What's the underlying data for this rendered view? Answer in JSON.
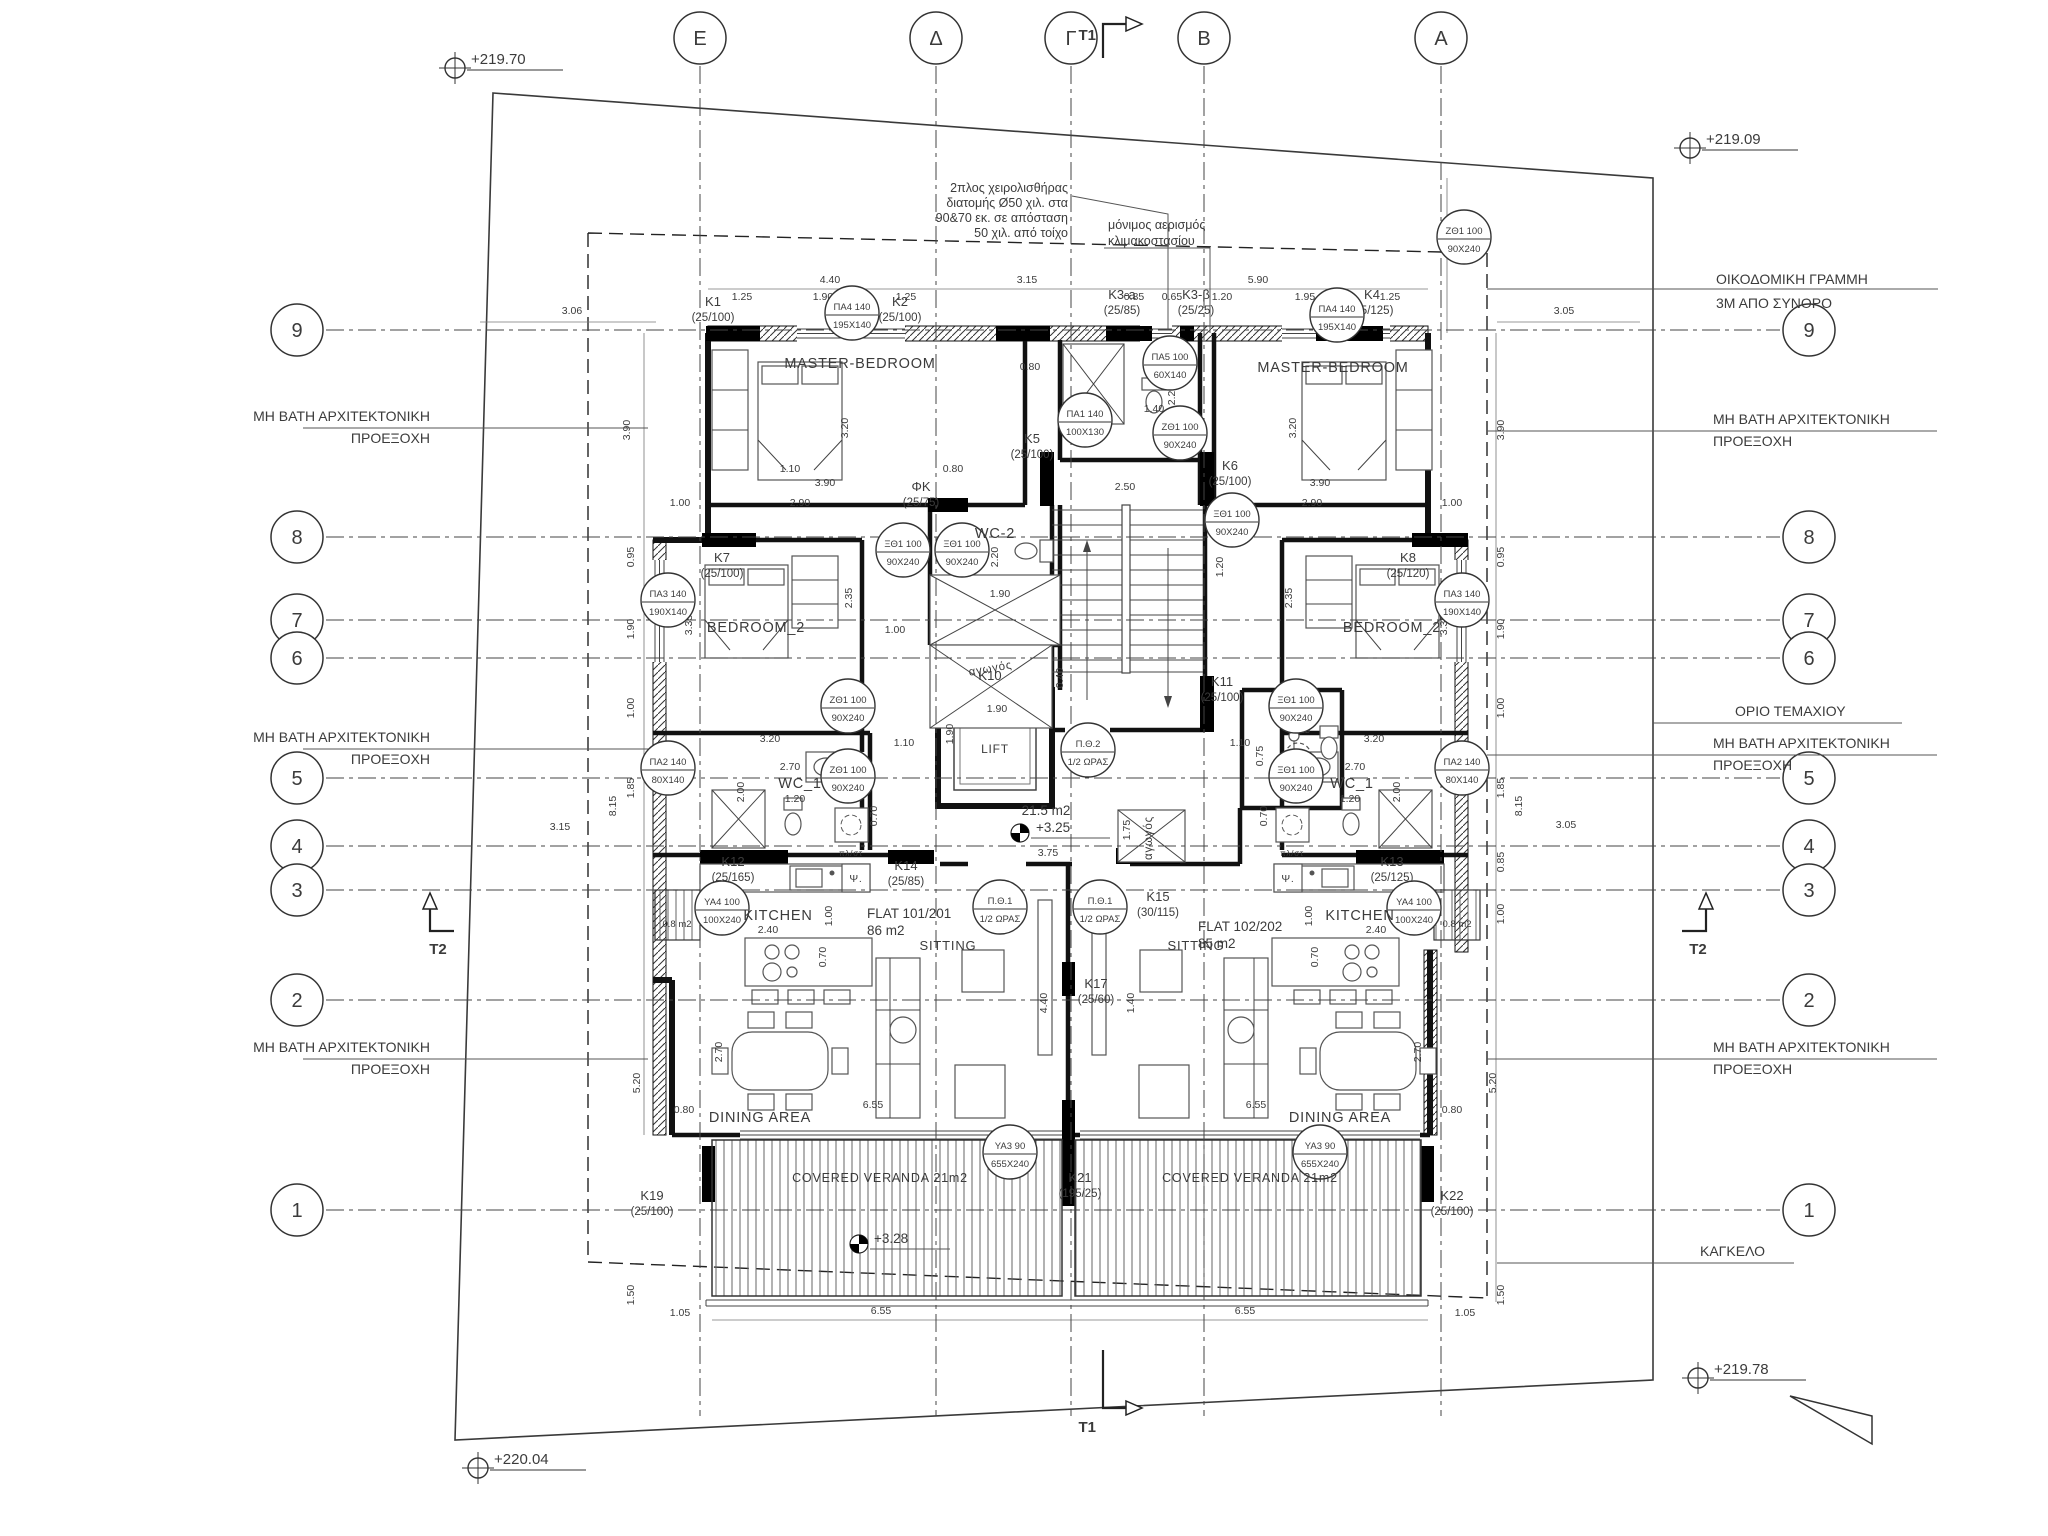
{
  "title": "Typical floor plan",
  "grid": {
    "columns": [
      {
        "l": "E",
        "x": 700
      },
      {
        "l": "Δ",
        "x": 936
      },
      {
        "l": "Γ",
        "x": 1071
      },
      {
        "l": "B",
        "x": 1204
      },
      {
        "l": "A",
        "x": 1441
      }
    ],
    "rows": [
      {
        "l": "9",
        "y": 330
      },
      {
        "l": "8",
        "y": 537
      },
      {
        "l": "7",
        "y": 620
      },
      {
        "l": "6",
        "y": 658
      },
      {
        "l": "5",
        "y": 778
      },
      {
        "l": "4",
        "y": 846
      },
      {
        "l": "3",
        "y": 890
      },
      {
        "l": "2",
        "y": 1000
      },
      {
        "l": "1",
        "y": 1210
      }
    ]
  },
  "markers": {
    "t1": "T1",
    "t2": "T2"
  },
  "levels": [
    {
      "t": "+219.70",
      "x": 455,
      "y": 68
    },
    {
      "t": "+219.09",
      "x": 1690,
      "y": 148
    },
    {
      "t": "+220.04",
      "x": 478,
      "y": 1468
    },
    {
      "t": "+219.78",
      "x": 1698,
      "y": 1378
    }
  ],
  "levels_rel": {
    "hall": "+3.25",
    "veranda": "+3.28"
  },
  "rooms": {
    "master": "MASTER-BEDROOM",
    "bedroom2": "BEDROOM_2",
    "wc1": "WC_1",
    "wc2": "WC-2",
    "kitchen": "KITCHEN",
    "sitting": "SITTING",
    "dining": "DINING AREA",
    "veranda": "COVERED VERANDA 21m2",
    "lift": "LIFT",
    "duct": "αγωγός",
    "fridge": "Ψ.",
    "wash": "πλ/στ"
  },
  "flats": {
    "f1_name": "FLAT 101/201",
    "f1_area": "86 m2",
    "f2_name": "FLAT 102/202",
    "f2_area": "85 m2",
    "hall_area": "21.5 m2",
    "shaft": "0.8 m2"
  },
  "notes": {
    "handrail": [
      "2πλος χειρολισθήρας",
      "διατομής Ø50 χιλ. στα",
      "90&70 εκ. σε απόσταση",
      "50 χιλ. από τοίχο"
    ],
    "vent": [
      "μόνιμος αερισμός",
      "κλιμακοστασίου"
    ],
    "building_line": [
      "ΟΙΚΟΔΟΜΙΚΗ ΓΡΑΜΜΗ",
      "3Μ ΑΠΟ ΣΥΝΟΡΟ"
    ],
    "plot_boundary": "ΟΡΙΟ ΤΕΜΑΧΙΟΥ",
    "railing": "ΚΑΓΚΕΛΟ",
    "projection": [
      "ΜΗ ΒΑΤΗ ΑΡΧΙΤΕΚΤΟΝΙΚΗ",
      "ΠΡΟΕΞΟΧΗ"
    ]
  },
  "projections": [
    {
      "x": 430,
      "y": 421,
      "side": "l"
    },
    {
      "x": 430,
      "y": 742,
      "side": "l"
    },
    {
      "x": 430,
      "y": 1052,
      "side": "l"
    },
    {
      "x": 1713,
      "y": 424,
      "side": "r"
    },
    {
      "x": 1713,
      "y": 748,
      "side": "r"
    },
    {
      "x": 1713,
      "y": 1052,
      "side": "r"
    }
  ],
  "columns": [
    {
      "id": "K1",
      "s": "(25/100)",
      "x": 713,
      "y": 306
    },
    {
      "id": "K2",
      "s": "(25/100)",
      "x": 900,
      "y": 306
    },
    {
      "id": "K3-a",
      "s": "(25/85)",
      "x": 1122,
      "y": 299
    },
    {
      "id": "K3-β",
      "s": "(25/25)",
      "x": 1196,
      "y": 299
    },
    {
      "id": "K4",
      "s": "(25/125)",
      "x": 1372,
      "y": 299
    },
    {
      "id": "K5",
      "s": "(25/100)",
      "x": 1032,
      "y": 443
    },
    {
      "id": "K6",
      "s": "(25/100)",
      "x": 1230,
      "y": 470
    },
    {
      "id": "K7",
      "s": "(25/100)",
      "x": 722,
      "y": 562
    },
    {
      "id": "K8",
      "s": "(25/120)",
      "x": 1408,
      "y": 562
    },
    {
      "id": "ΦΚ",
      "s": "(25/75)",
      "x": 921,
      "y": 491
    },
    {
      "id": "K10",
      "s": "",
      "x": 990,
      "y": 680
    },
    {
      "id": "K11",
      "s": "(25/100)",
      "x": 1222,
      "y": 686
    },
    {
      "id": "K12",
      "s": "(25/165)",
      "x": 733,
      "y": 866
    },
    {
      "id": "K13",
      "s": "(25/125)",
      "x": 1392,
      "y": 866
    },
    {
      "id": "K14",
      "s": "(25/85)",
      "x": 906,
      "y": 870
    },
    {
      "id": "K15",
      "s": "(30/115)",
      "x": 1158,
      "y": 901
    },
    {
      "id": "K17",
      "s": "(25/60)",
      "x": 1096,
      "y": 988
    },
    {
      "id": "K19",
      "s": "(25/100)",
      "x": 652,
      "y": 1200
    },
    {
      "id": "K21",
      "s": "(195/25)",
      "x": 1080,
      "y": 1182
    },
    {
      "id": "K22",
      "s": "(25/100)",
      "x": 1452,
      "y": 1200
    }
  ],
  "tags": [
    {
      "c": "ΠΑ4 140",
      "s": "195X140",
      "x": 852,
      "y": 313
    },
    {
      "c": "ΠΑ4 140",
      "s": "195X140",
      "x": 1337,
      "y": 315
    },
    {
      "c": "ΠΑ5 100",
      "s": "60X140",
      "x": 1170,
      "y": 363
    },
    {
      "c": "ΠΑ1 140",
      "s": "100X130",
      "x": 1085,
      "y": 420
    },
    {
      "c": "ΞΘ1 100",
      "s": "90X240",
      "x": 903,
      "y": 550
    },
    {
      "c": "ΞΘ1 100",
      "s": "90X240",
      "x": 962,
      "y": 550
    },
    {
      "c": "ΞΘ1 100",
      "s": "90X240",
      "x": 1232,
      "y": 520
    },
    {
      "c": "ΖΘ1 100",
      "s": "90X240",
      "x": 1464,
      "y": 237
    },
    {
      "c": "ΖΘ1 100",
      "s": "90X240",
      "x": 1180,
      "y": 433
    },
    {
      "c": "ΠΑ3 140",
      "s": "190X140",
      "x": 668,
      "y": 600
    },
    {
      "c": "ΠΑ3 140",
      "s": "190X140",
      "x": 1462,
      "y": 600
    },
    {
      "c": "ΖΘ1 100",
      "s": "90X240",
      "x": 848,
      "y": 706
    },
    {
      "c": "ΞΘ1 100",
      "s": "90X240",
      "x": 1296,
      "y": 706
    },
    {
      "c": "ΖΘ1 100",
      "s": "90X240",
      "x": 848,
      "y": 776
    },
    {
      "c": "ΞΘ1 100",
      "s": "90X240",
      "x": 1296,
      "y": 776
    },
    {
      "c": "ΠΑ2 140",
      "s": "80X140",
      "x": 668,
      "y": 768
    },
    {
      "c": "ΠΑ2 140",
      "s": "80X140",
      "x": 1462,
      "y": 768
    },
    {
      "c": "ΥΑ4 100",
      "s": "100X240",
      "x": 722,
      "y": 908
    },
    {
      "c": "ΥΑ4 100",
      "s": "100X240",
      "x": 1414,
      "y": 908
    },
    {
      "c": "Π.Θ.1",
      "s": "1/2 ΩΡΑΣ",
      "x": 1000,
      "y": 907
    },
    {
      "c": "Π.Θ.1",
      "s": "1/2 ΩΡΑΣ",
      "x": 1100,
      "y": 907
    },
    {
      "c": "Π.Θ.2",
      "s": "1/2 ΩΡΑΣ",
      "x": 1088,
      "y": 750
    },
    {
      "c": "ΥΑ3 90",
      "s": "655X240",
      "x": 1010,
      "y": 1152
    },
    {
      "c": "ΥΑ3 90",
      "s": "655X240",
      "x": 1320,
      "y": 1152
    }
  ],
  "dims": [
    {
      "t": "4.40",
      "x": 830,
      "y": 283
    },
    {
      "t": "3.15",
      "x": 1027,
      "y": 283
    },
    {
      "t": "5.90",
      "x": 1258,
      "y": 283
    },
    {
      "t": "1.25",
      "x": 742,
      "y": 300
    },
    {
      "t": "1.90",
      "x": 823,
      "y": 300
    },
    {
      "t": "1.25",
      "x": 906,
      "y": 300
    },
    {
      "t": "0.85",
      "x": 1134,
      "y": 300
    },
    {
      "t": "0.65",
      "x": 1172,
      "y": 300
    },
    {
      "t": "1.20",
      "x": 1222,
      "y": 300
    },
    {
      "t": "1.95",
      "x": 1305,
      "y": 300
    },
    {
      "t": "1.25",
      "x": 1390,
      "y": 300
    },
    {
      "t": "3.06",
      "x": 572,
      "y": 314
    },
    {
      "t": "3.05",
      "x": 1564,
      "y": 314
    },
    {
      "t": "4.28",
      "x": 1452,
      "y": 230,
      "r": 1
    },
    {
      "t": "3.90",
      "x": 630,
      "y": 430,
      "r": 1
    },
    {
      "t": "0.95",
      "x": 634,
      "y": 557,
      "r": 1
    },
    {
      "t": "1.90",
      "x": 634,
      "y": 629,
      "r": 1
    },
    {
      "t": "1.00",
      "x": 634,
      "y": 708,
      "r": 1
    },
    {
      "t": "1.85",
      "x": 634,
      "y": 788,
      "r": 1
    },
    {
      "t": "8.15",
      "x": 616,
      "y": 806,
      "r": 1
    },
    {
      "t": "3.15",
      "x": 560,
      "y": 830
    },
    {
      "t": "5.20",
      "x": 640,
      "y": 1083,
      "r": 1
    },
    {
      "t": "0.80",
      "x": 684,
      "y": 1113
    },
    {
      "t": "1.50",
      "x": 634,
      "y": 1295,
      "r": 1
    },
    {
      "t": "1.05",
      "x": 680,
      "y": 1316
    },
    {
      "t": "3.90",
      "x": 1504,
      "y": 430,
      "r": 1
    },
    {
      "t": "0.95",
      "x": 1504,
      "y": 557,
      "r": 1
    },
    {
      "t": "1.90",
      "x": 1504,
      "y": 629,
      "r": 1
    },
    {
      "t": "1.00",
      "x": 1504,
      "y": 708,
      "r": 1
    },
    {
      "t": "1.85",
      "x": 1504,
      "y": 788,
      "r": 1
    },
    {
      "t": "8.15",
      "x": 1522,
      "y": 806,
      "r": 1
    },
    {
      "t": "0.85",
      "x": 1504,
      "y": 862,
      "r": 1
    },
    {
      "t": "1.00",
      "x": 1504,
      "y": 914,
      "r": 1
    },
    {
      "t": "3.05",
      "x": 1566,
      "y": 828
    },
    {
      "t": "5.20",
      "x": 1496,
      "y": 1083,
      "r": 1
    },
    {
      "t": "0.80",
      "x": 1452,
      "y": 1113
    },
    {
      "t": "1.50",
      "x": 1504,
      "y": 1295,
      "r": 1
    },
    {
      "t": "1.05",
      "x": 1465,
      "y": 1316
    },
    {
      "t": "3.20",
      "x": 848,
      "y": 428,
      "r": 1
    },
    {
      "t": "3.90",
      "x": 825,
      "y": 486
    },
    {
      "t": "2.90",
      "x": 800,
      "y": 506
    },
    {
      "t": "1.00",
      "x": 680,
      "y": 506
    },
    {
      "t": "3.20",
      "x": 1296,
      "y": 428,
      "r": 1
    },
    {
      "t": "3.90",
      "x": 1320,
      "y": 486
    },
    {
      "t": "2.90",
      "x": 1312,
      "y": 506
    },
    {
      "t": "1.00",
      "x": 1452,
      "y": 506
    },
    {
      "t": "1.10",
      "x": 790,
      "y": 472
    },
    {
      "t": "0.80",
      "x": 953,
      "y": 472
    },
    {
      "t": "1.40",
      "x": 1154,
      "y": 412
    },
    {
      "t": "1.00",
      "x": 1090,
      "y": 440
    },
    {
      "t": "2.20",
      "x": 1175,
      "y": 395,
      "r": 1
    },
    {
      "t": "2.50",
      "x": 1125,
      "y": 490
    },
    {
      "t": "0.80",
      "x": 1030,
      "y": 370
    },
    {
      "t": "2.20",
      "x": 998,
      "y": 557,
      "r": 1
    },
    {
      "t": "1.90",
      "x": 1000,
      "y": 597
    },
    {
      "t": "1.00",
      "x": 895,
      "y": 633
    },
    {
      "t": "2.35",
      "x": 852,
      "y": 598,
      "r": 1
    },
    {
      "t": "3.35",
      "x": 692,
      "y": 625,
      "r": 1
    },
    {
      "t": "3.20",
      "x": 770,
      "y": 742
    },
    {
      "t": "2.35",
      "x": 1292,
      "y": 598,
      "r": 1
    },
    {
      "t": "3.35",
      "x": 1447,
      "y": 625,
      "r": 1
    },
    {
      "t": "3.20",
      "x": 1374,
      "y": 742
    },
    {
      "t": "1.10",
      "x": 904,
      "y": 746
    },
    {
      "t": "1.10",
      "x": 1240,
      "y": 746
    },
    {
      "t": "2.70",
      "x": 790,
      "y": 770
    },
    {
      "t": "2.00",
      "x": 744,
      "y": 792,
      "r": 1
    },
    {
      "t": "1.20",
      "x": 795,
      "y": 802
    },
    {
      "t": "2.70",
      "x": 1355,
      "y": 770
    },
    {
      "t": "2.00",
      "x": 1400,
      "y": 792,
      "r": 1
    },
    {
      "t": "1.20",
      "x": 1350,
      "y": 802
    },
    {
      "t": "0.70",
      "x": 877,
      "y": 816,
      "r": 1
    },
    {
      "t": "0.70",
      "x": 1267,
      "y": 816,
      "r": 1
    },
    {
      "t": "1.90",
      "x": 997,
      "y": 712
    },
    {
      "t": "1.90",
      "x": 953,
      "y": 734,
      "r": 1
    },
    {
      "t": "0.40",
      "x": 1063,
      "y": 678,
      "r": 1
    },
    {
      "t": "1.20",
      "x": 1223,
      "y": 567,
      "r": 1
    },
    {
      "t": "1.25",
      "x": 1300,
      "y": 733
    },
    {
      "t": "0.75",
      "x": 1263,
      "y": 756,
      "r": 1
    },
    {
      "t": "3.75",
      "x": 1048,
      "y": 856
    },
    {
      "t": "1.75",
      "x": 1130,
      "y": 830,
      "r": 1
    },
    {
      "t": "2.40",
      "x": 768,
      "y": 933
    },
    {
      "t": "1.00",
      "x": 832,
      "y": 916,
      "r": 1
    },
    {
      "t": "0.70",
      "x": 826,
      "y": 957,
      "r": 1
    },
    {
      "t": "2.40",
      "x": 1376,
      "y": 933
    },
    {
      "t": "1.00",
      "x": 1312,
      "y": 916,
      "r": 1
    },
    {
      "t": "0.70",
      "x": 1318,
      "y": 957,
      "r": 1
    },
    {
      "t": "4.40",
      "x": 1047,
      "y": 1003,
      "r": 1
    },
    {
      "t": "1.40",
      "x": 1134,
      "y": 1003,
      "r": 1
    },
    {
      "t": "2.70",
      "x": 722,
      "y": 1052,
      "r": 1
    },
    {
      "t": "2.70",
      "x": 1421,
      "y": 1052,
      "r": 1
    },
    {
      "t": "6.55",
      "x": 873,
      "y": 1108
    },
    {
      "t": "6.55",
      "x": 1256,
      "y": 1108
    },
    {
      "t": "6.55",
      "x": 881,
      "y": 1314
    },
    {
      "t": "6.55",
      "x": 1245,
      "y": 1314
    }
  ]
}
